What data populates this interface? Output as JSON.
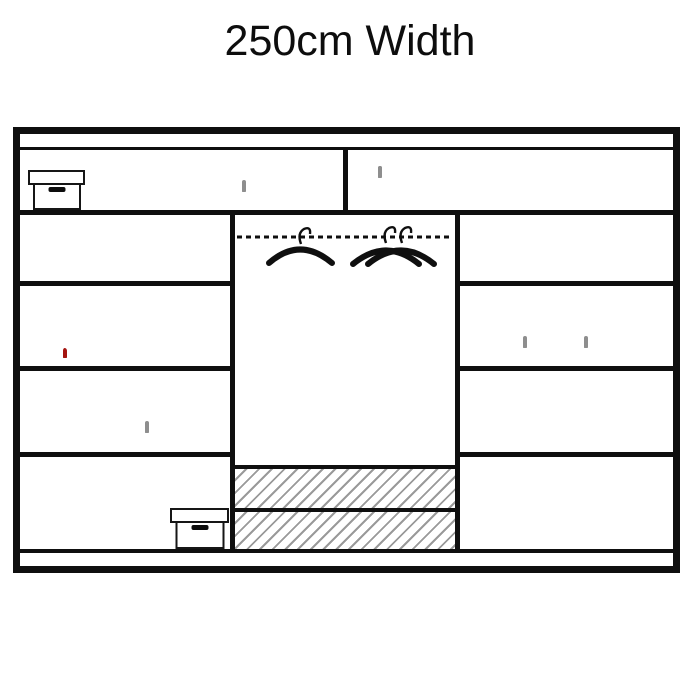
{
  "title": "250cm Width",
  "diagram": {
    "kind": "wardrobe-interior-layout",
    "width_label": "250cm Width",
    "columns": [
      "left-shelf-column",
      "center-hanging-section",
      "right-shelf-column"
    ],
    "center_section": {
      "rail": "dashed-hanging-rail",
      "hangers": 3,
      "drawers": 2
    }
  },
  "colors": {
    "line": "#0f0f0f",
    "towel_outline": "#8e8e8e",
    "red_towel_fill": "#e8291c",
    "red_towel_border": "#a41410",
    "hatch_line": "#9a9a9a",
    "background": "#ffffff"
  },
  "items": [
    {
      "name": "storage-box",
      "location": "top-shelf-left"
    },
    {
      "name": "folded-towel",
      "location": "top-shelf-center",
      "layers": 2
    },
    {
      "name": "folded-towel",
      "location": "top-shelf-right",
      "layers": 3
    },
    {
      "name": "clothes-hanger",
      "location": "hanging-rail-left",
      "count": 1
    },
    {
      "name": "clothes-hanger-pair",
      "location": "hanging-rail-right",
      "count": 2
    },
    {
      "name": "folded-towel-red",
      "location": "left-column-middle-shelf",
      "color": "#e8291c"
    },
    {
      "name": "folded-towel",
      "location": "left-column-lower-shelf",
      "layers": 2
    },
    {
      "name": "storage-box",
      "location": "left-column-bottom-shelf"
    },
    {
      "name": "folded-towel",
      "location": "right-column-middle-shelf-left",
      "layers": 2
    },
    {
      "name": "folded-towel",
      "location": "right-column-middle-shelf-right",
      "layers": 2
    },
    {
      "name": "hatched-drawer",
      "location": "center-bottom-upper"
    },
    {
      "name": "hatched-drawer",
      "location": "center-bottom-lower"
    }
  ]
}
